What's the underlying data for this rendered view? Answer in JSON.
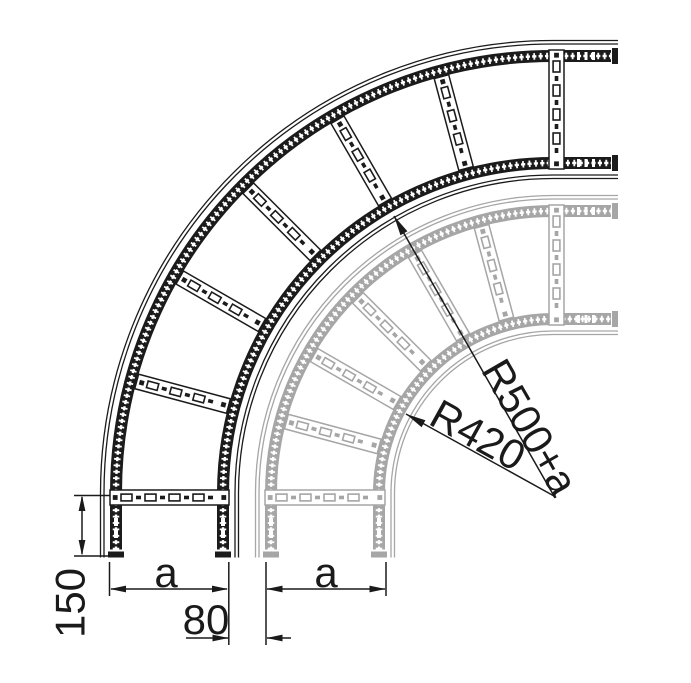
{
  "title": "90 degree cable ladder bend - dimensioned technical drawing",
  "colors": {
    "primary": "#1b1b1b",
    "secondary": "#a6a6a6",
    "dimension": "#1a1a1a",
    "background": "#ffffff"
  },
  "labels": {
    "tail_length": "150",
    "ladder_width_primary": "a",
    "ladder_width_secondary": "a",
    "ladder_offset": "80",
    "radius_secondary": "R420",
    "radius_primary": "R500+a"
  },
  "drawing": {
    "center": {
      "x": 553,
      "y": 493
    },
    "rail_width": 12,
    "tail_bottom_end_y": 557.5,
    "tail_right_end_x": 618,
    "rung_angles_deg": [
      15,
      30,
      45,
      60,
      75
    ],
    "ladders": [
      {
        "name": "ladder-secondary",
        "color_key": "secondary",
        "r_outer": 288,
        "r_inner": 168
      },
      {
        "name": "ladder-primary",
        "color_key": "primary",
        "r_outer": 443,
        "r_inner": 324
      }
    ]
  }
}
